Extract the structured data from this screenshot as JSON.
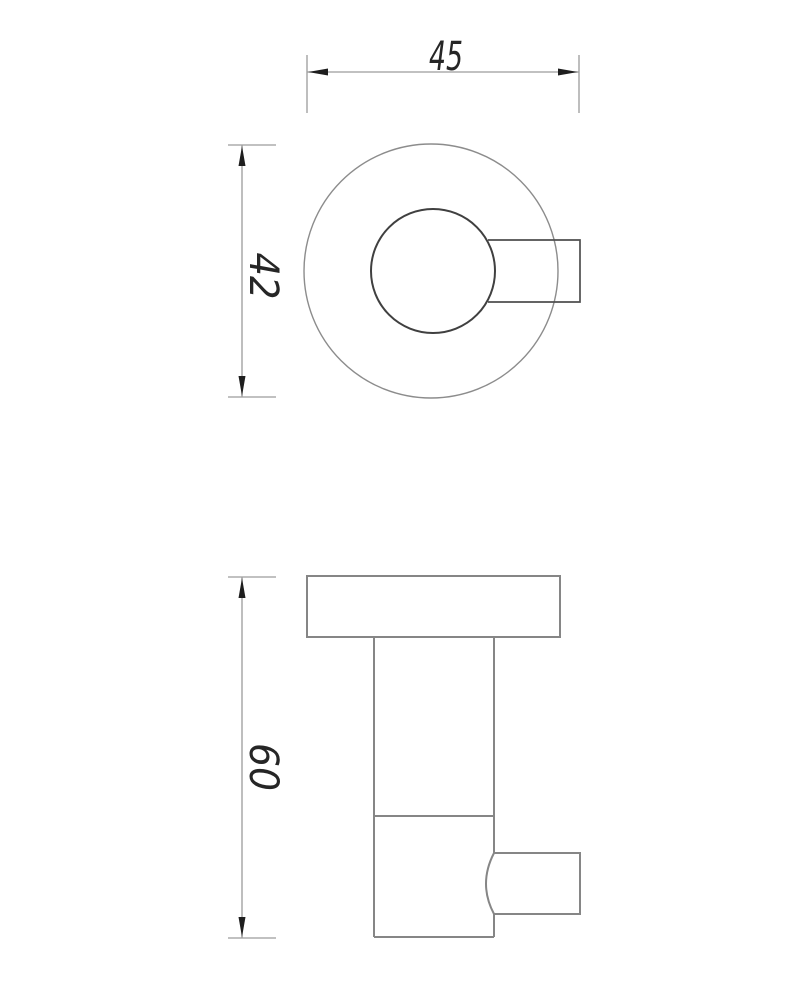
{
  "drawing": {
    "type": "technical-drawing",
    "dimensions": {
      "overall_width": {
        "value": "45",
        "orientation": "horizontal"
      },
      "flange_diameter": {
        "value": "42",
        "orientation": "vertical"
      },
      "overall_height": {
        "value": "60",
        "orientation": "vertical"
      }
    },
    "colors": {
      "background": "#ffffff",
      "object_line": "#868686",
      "outer_circle_line": "#8c8c8c",
      "inner_circle_line": "#404040",
      "detail_line": "#4f4f4f",
      "dimension_line": "#9c9c9c",
      "arrow": "#1e1e1e",
      "text": "#262626"
    }
  }
}
